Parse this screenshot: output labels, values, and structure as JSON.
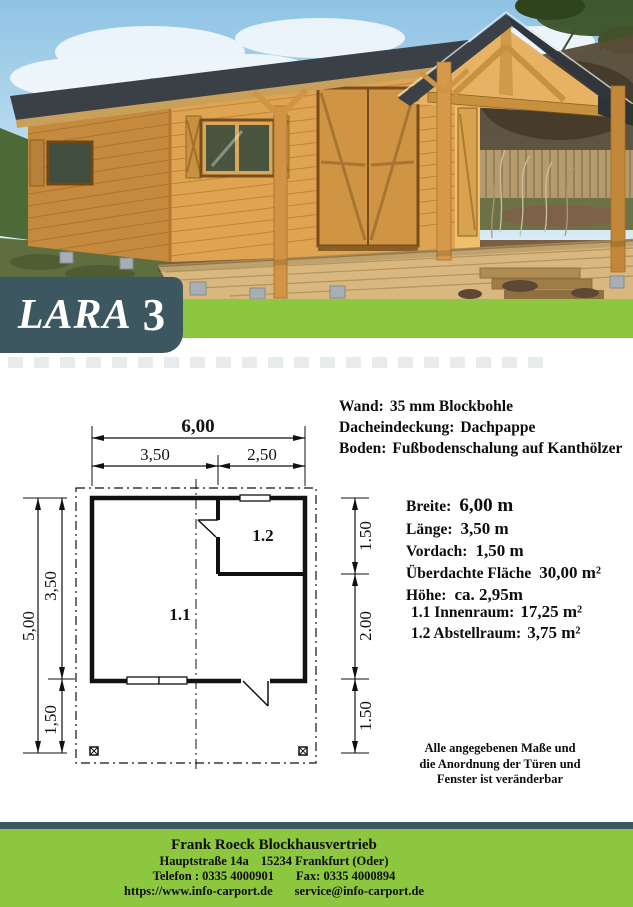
{
  "banner": {
    "name": "LARA",
    "number": "3"
  },
  "colors": {
    "accent_green": "#8dc63f",
    "banner_slate": "#3d5761",
    "text": "#0d0d0d"
  },
  "construction": [
    {
      "label": "Wand:",
      "value": "35 mm Blockbohle"
    },
    {
      "label": "Dacheindeckung:",
      "value": "Dachpappe"
    },
    {
      "label": "Boden:",
      "value": "Fußbodenschalung auf Kanthölzer"
    }
  ],
  "specs": [
    {
      "label": "Breite:",
      "value": "6,00 m"
    },
    {
      "label": "Länge:",
      "value": "3,50 m"
    },
    {
      "label": "Vordach:",
      "value": "1,50 m"
    },
    {
      "label": "Überdachte Fläche",
      "value": "30,00 m²"
    },
    {
      "label": "Höhe:",
      "value": "ca. 2,95m"
    }
  ],
  "rooms": [
    {
      "label": "1.1 Innenraum:",
      "value": "17,25 m²"
    },
    {
      "label": "1.2 Abstellraum:",
      "value": "3,75 m²"
    }
  ],
  "note": {
    "line1": "Alle angegebenen Maße und",
    "line2": "die Anordnung der Türen und",
    "line3": "Fenster ist veränderbar"
  },
  "plan": {
    "dims_top": {
      "total": "6,00",
      "left": "3,50",
      "right": "2,50"
    },
    "dims_left": {
      "total": "5,00",
      "upper": "3,50",
      "lower": "1,50"
    },
    "dims_right": {
      "upper": "1.50",
      "middle": "2.00",
      "lower": "1.50"
    },
    "rooms": {
      "main": "1.1",
      "storage": "1.2"
    }
  },
  "footer": {
    "company": "Frank Roeck Blockhausvertrieb",
    "street": "Hauptstraße 14a",
    "city": "15234 Frankfurt (Oder)",
    "phone": "Telefon : 0335 4000901",
    "fax": "Fax: 0335 4000894",
    "website": "https://www.info-carport.de",
    "email": "service@info-carport.de"
  }
}
